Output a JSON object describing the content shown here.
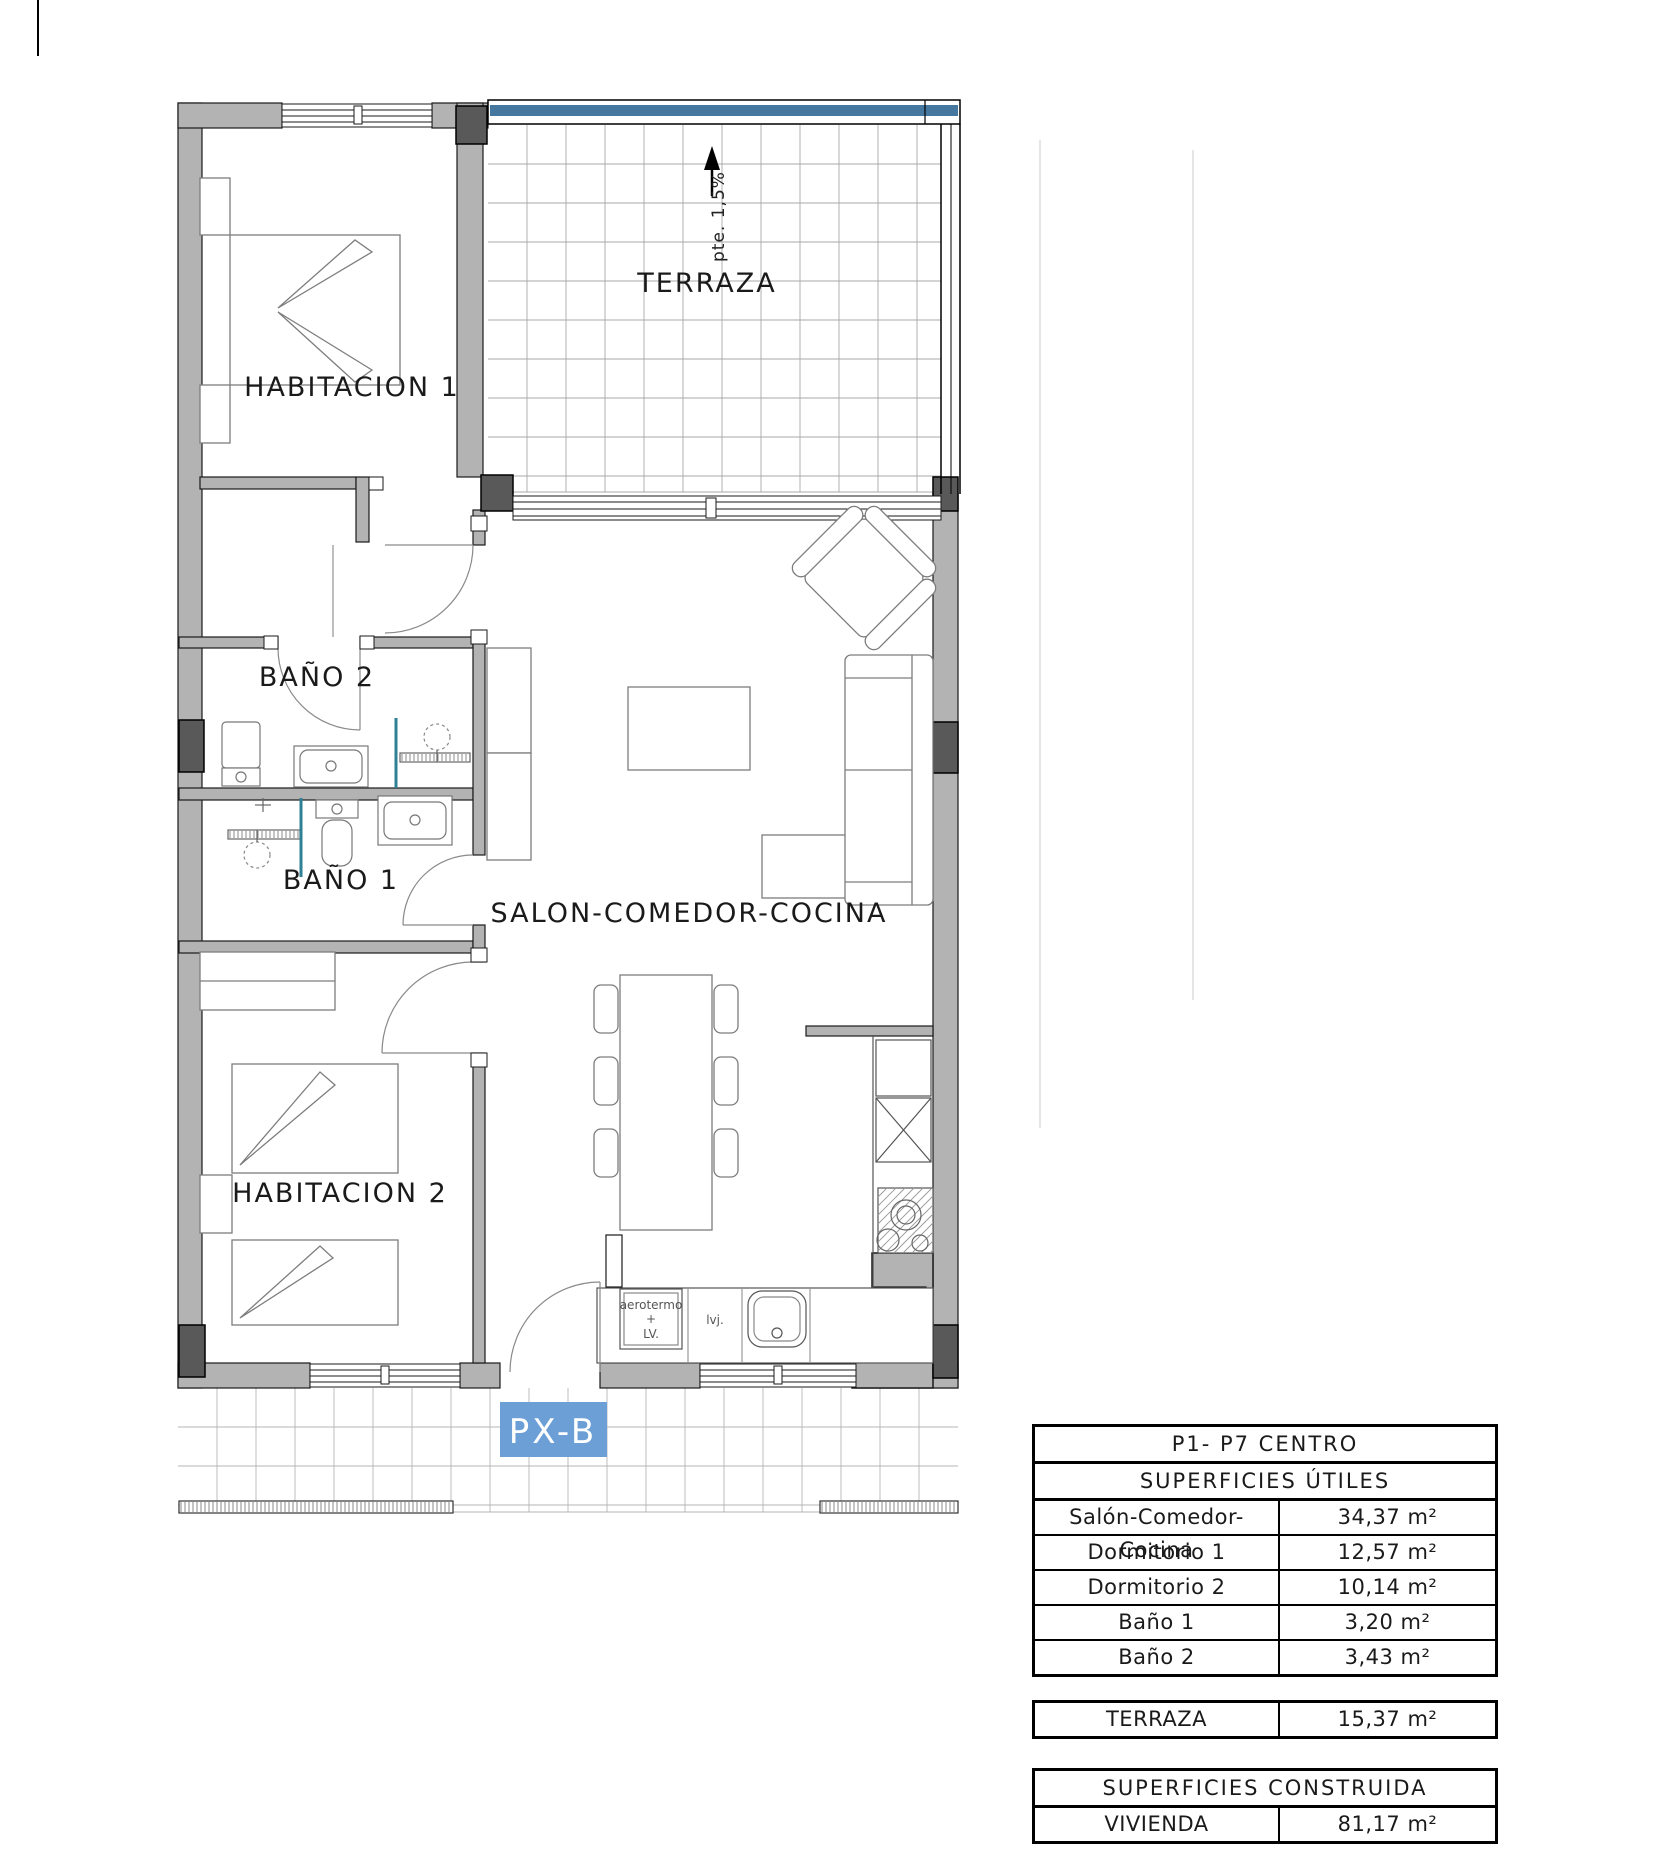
{
  "plan": {
    "code_label": "PX-B",
    "slope_note": "pte. 1,5%",
    "rooms": {
      "habitacion1": "HABITACION 1",
      "terraza": "TERRAZA",
      "bano2": "BAÑO 2",
      "bano1": "BAÑO 1",
      "salon": "SALON-COMEDOR-COCINA",
      "habitacion2": "HABITACION 2"
    },
    "kitchen": {
      "aerotermo_lines": [
        "aerotermo",
        "+",
        "LV."
      ],
      "lvj": "lvj."
    },
    "colors": {
      "wall": "#b3b3b3",
      "pillar": "#595959",
      "glass_band": "#46789f",
      "code_bg": "#6b9fd6",
      "shower_screen": "#2f7f95"
    }
  },
  "tables": {
    "utiles": {
      "title": "P1- P7 CENTRO",
      "subtitle": "SUPERFICIES ÚTILES",
      "rows": [
        {
          "label": "Salón-Comedor-Cocina",
          "value": "34,37 m²"
        },
        {
          "label": "Dormitorio 1",
          "value": "12,57 m²"
        },
        {
          "label": "Dormitorio 2",
          "value": "10,14 m²"
        },
        {
          "label": "Baño 1",
          "value": "3,20 m²"
        },
        {
          "label": "Baño 2",
          "value": "3,43 m²"
        }
      ]
    },
    "terraza": {
      "label": "TERRAZA",
      "value": "15,37 m²"
    },
    "construida": {
      "title": "SUPERFICIES CONSTRUIDA",
      "rows": [
        {
          "label": "VIVIENDA",
          "value": "81,17 m²"
        }
      ]
    }
  }
}
